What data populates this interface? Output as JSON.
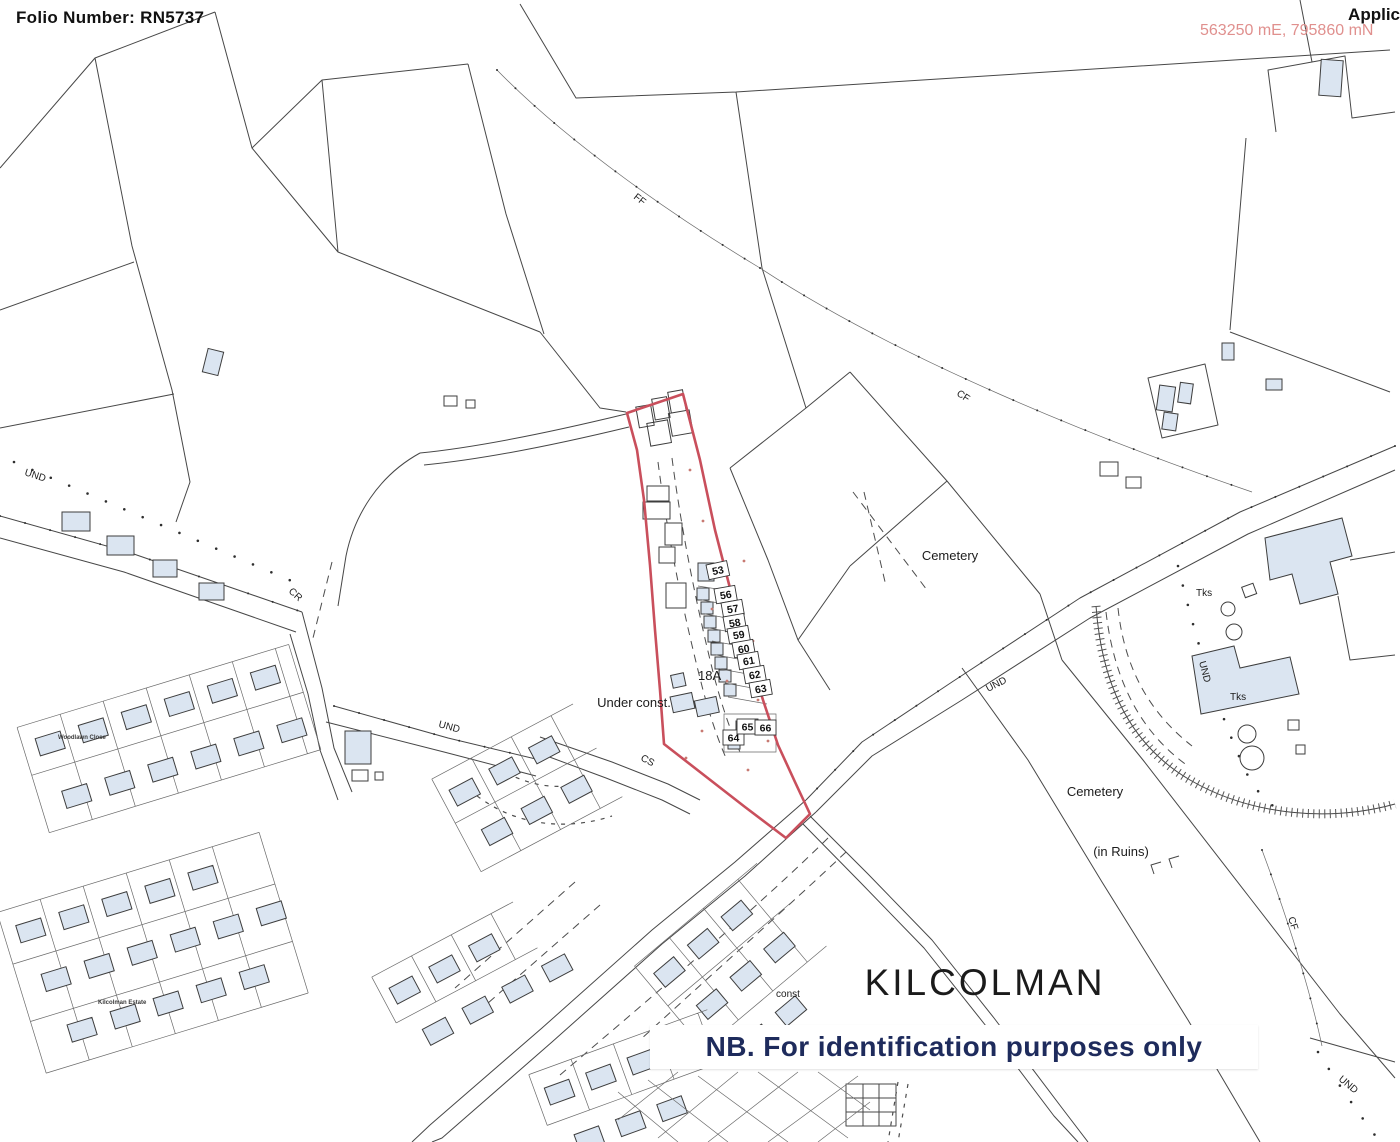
{
  "header": {
    "folio_label": "Folio Number: RN5737",
    "applicant_label": "Applic",
    "coordinates": "563250 mE, 795860 mN"
  },
  "banner": {
    "note": "NB. For identification purposes only"
  },
  "map": {
    "townland": "KILCOLMAN",
    "labels": {
      "cemetery_upper": "Cemetery",
      "cemetery_lower": "Cemetery",
      "in_ruins": "(in Ruins)",
      "under_const": "Under const.",
      "const_partial": "const",
      "plot_18a": "18A",
      "woodlawn_close": "Woodlawn Close",
      "kilcolman_estate": "Kilcolman Estate",
      "und": "UND",
      "cr": "CR",
      "cs": "CS",
      "ff": "FF",
      "cf": "CF",
      "tks": "Tks"
    },
    "plot_numbers": [
      "53",
      "56",
      "57",
      "58",
      "59",
      "60",
      "61",
      "62",
      "63",
      "64",
      "65",
      "66"
    ],
    "colors": {
      "plot_boundary": "#c94f5c",
      "building_fill": "#dbe5f1",
      "coordinates_text": "#e0908e",
      "banner_text": "#1e2b5c"
    }
  }
}
